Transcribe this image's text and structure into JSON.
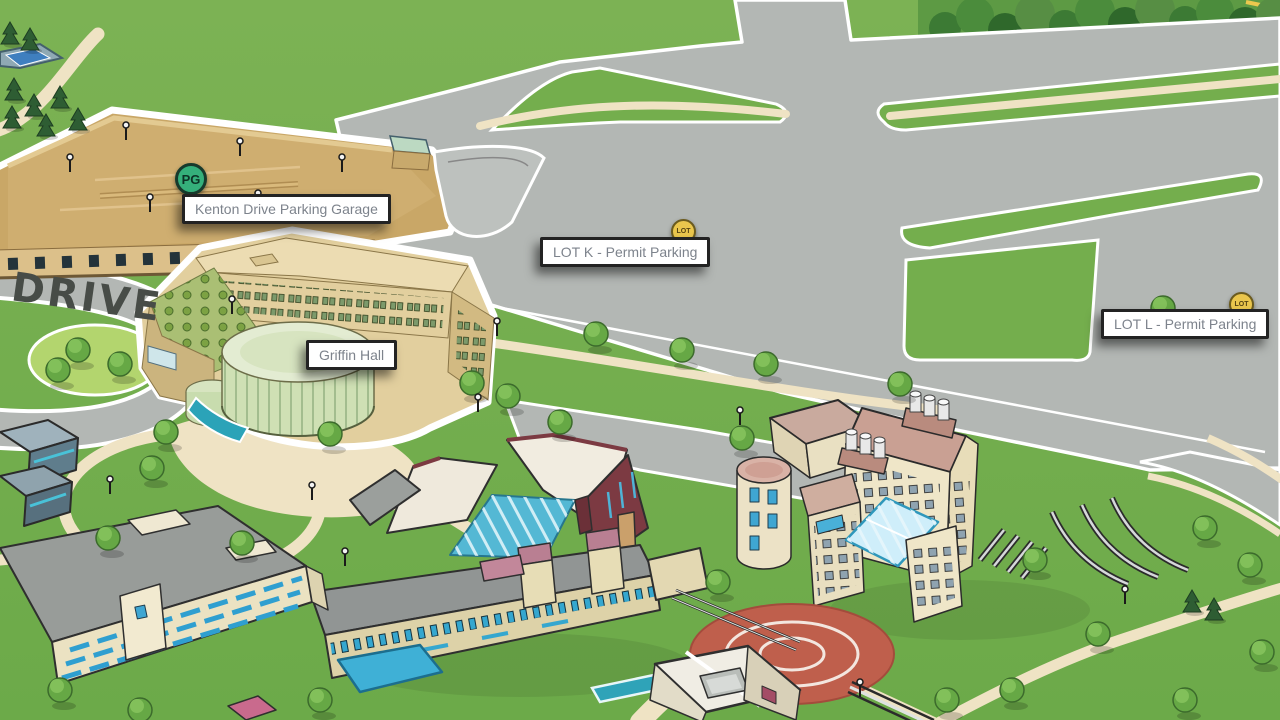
{
  "app": {
    "name": "Campus Map"
  },
  "map": {
    "road_label": "DRIVE",
    "markers": [
      {
        "id": "kenton-drive-parking-garage",
        "label": "Kenton Drive Parking Garage",
        "icon_text": "PG",
        "icon_color": "#35b07b",
        "type": "parking-garage"
      },
      {
        "id": "griffin-hall",
        "label": "Griffin Hall",
        "icon_text": "",
        "icon_color": "",
        "type": "building"
      },
      {
        "id": "lot-k",
        "label": "LOT K - Permit Parking",
        "icon_text": "LOT",
        "icon_color": "#eac64d",
        "type": "parking-lot"
      },
      {
        "id": "lot-l",
        "label": "LOT L - Permit Parking",
        "icon_text": "LOT",
        "icon_color": "#eac64d",
        "type": "parking-lot"
      }
    ],
    "colors": {
      "grass": "#74ae4d",
      "road": "#b3b7b4",
      "walkway": "#efe3c4",
      "label_border": "#232323",
      "label_text": "#7d838c",
      "garage_deck": "#c9a767",
      "plaza_red": "#bf5f4c",
      "glass_blue": "#49b6d2"
    }
  }
}
